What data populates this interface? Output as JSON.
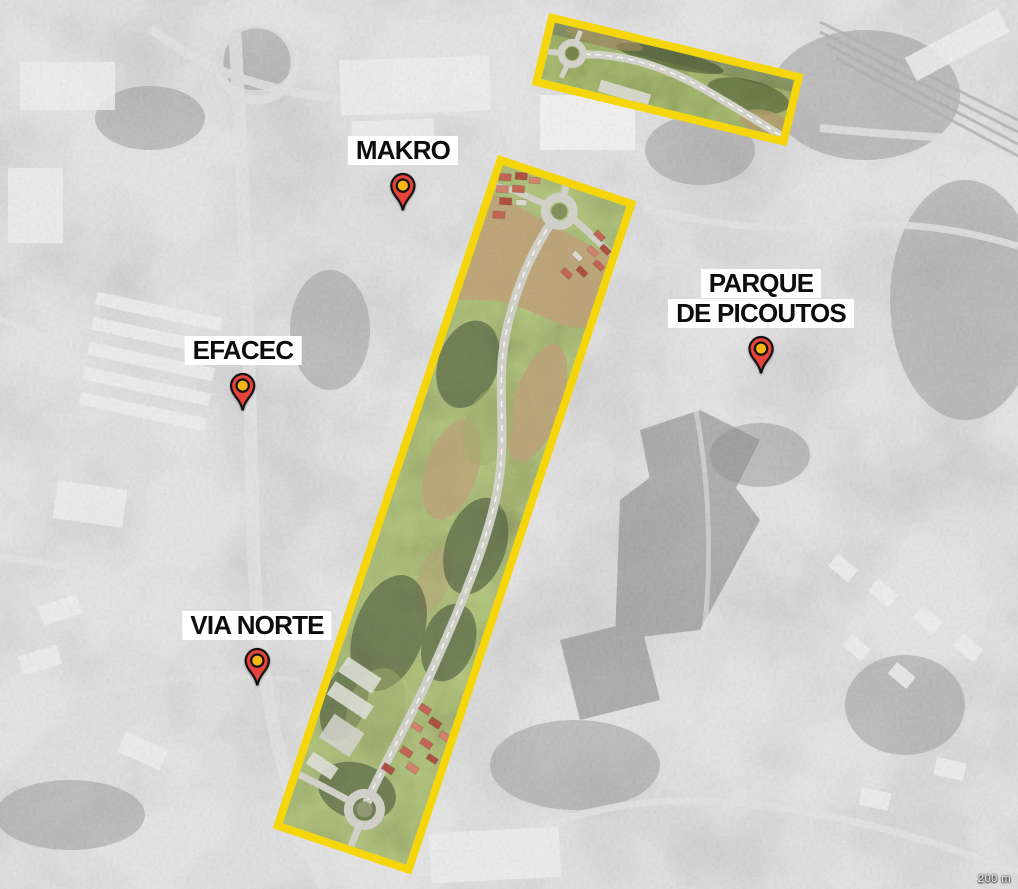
{
  "map": {
    "scale_label": "200 m",
    "colors": {
      "highlight": "#f5d60a",
      "pin_body": "#e8433b",
      "pin_center": "#fcb614",
      "pin_outline": "#141414"
    },
    "markers": [
      {
        "label": "MAKRO"
      },
      {
        "label": "EFACEC"
      },
      {
        "label": "VIA NORTE"
      },
      {
        "lines": [
          "PARQUE",
          "DE PICOUTOS"
        ]
      }
    ]
  }
}
